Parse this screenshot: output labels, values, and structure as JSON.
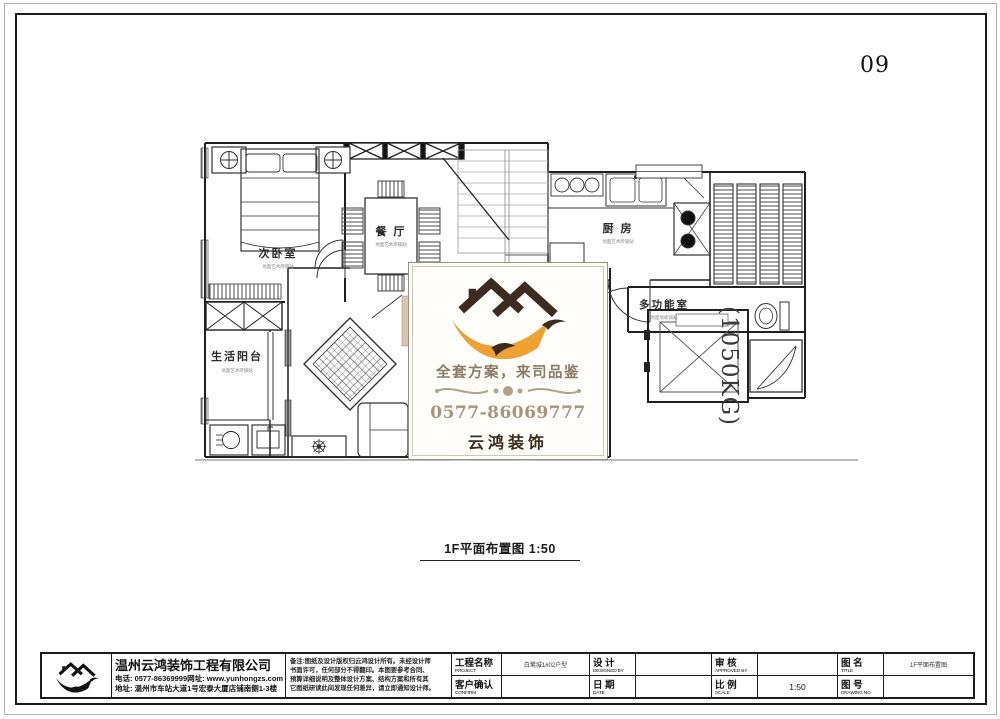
{
  "page_number": "09",
  "caption": "1F平面布置图 1:50",
  "plan": {
    "rooms": [
      {
        "name": "次卧室",
        "note": "地面艺术砖铺贴"
      },
      {
        "name": "餐 厅",
        "note": "地面艺术砖铺贴"
      },
      {
        "name": "厨 房",
        "note": "地面艺术砖铺贴"
      },
      {
        "name": "多功能室",
        "note": "地面地板铺贴"
      },
      {
        "name": "生活阳台",
        "note": "地面艺术砖铺贴"
      }
    ],
    "elevator_capacity": "(1050KG)"
  },
  "watermark": {
    "slogan": "全套方案，来司品鉴",
    "phone": "0577-86069777",
    "brand": "云鸿装饰",
    "colors": {
      "accent_orange": "#f0a230",
      "logo_brown": "#3d2b1f",
      "tan": "#a8937c"
    }
  },
  "title_block": {
    "company": {
      "name": "温州云鸿装饰工程有限公司",
      "tel_line": "电话: 0577-86369999网址: www.yunhongzs.com",
      "addr_line": "地址: 温州市车站大道1号宏泰大厦店铺南侧1-3楼"
    },
    "notes": [
      "备注:图纸及设计版权归云鸿设计所有。未经设计师",
      "书面许可，任何部分不得翻印。本图要参考合同、",
      "预算详细说明及整体设计方案、结构方案和所有其",
      "它图纸研读此间发现任何差异，请立即通知设计师。"
    ],
    "fields": [
      {
        "label": "工程名称",
        "sub": "PROJECT",
        "value": "白鹭城1#02户型"
      },
      {
        "label": "客户确认",
        "sub": "CONFIRM",
        "value": ""
      },
      {
        "label": "设 计",
        "sub": "DESIGNED BY",
        "value": ""
      },
      {
        "label": "日 期",
        "sub": "DATE",
        "value": ""
      },
      {
        "label": "审 核",
        "sub": "APPROVED BY",
        "value": ""
      },
      {
        "label": "比 例",
        "sub": "SCALE",
        "value": "1:50"
      },
      {
        "label": "图 名",
        "sub": "TITLE",
        "value": "1F平面布置图"
      },
      {
        "label": "图 号",
        "sub": "DRAWING NO",
        "value": ""
      }
    ]
  }
}
